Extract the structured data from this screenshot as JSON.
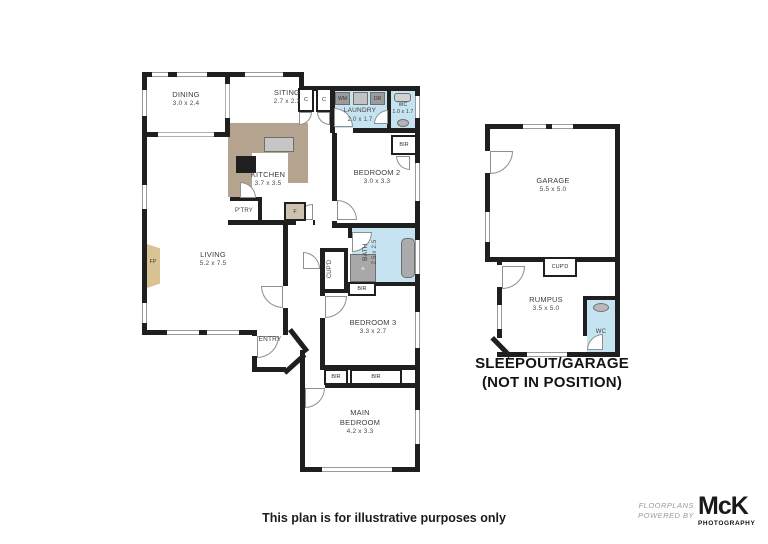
{
  "plan": {
    "rooms": {
      "dining": {
        "name": "DINING",
        "dims": "3.0 x 2.4"
      },
      "siting": {
        "name": "SITING",
        "dims": "2.7 x 2.3"
      },
      "kitchen": {
        "name": "KITCHEN",
        "dims": "3.7 x 3.5"
      },
      "laundry": {
        "name": "LAUNDRY",
        "dims": "2.0 x 1.7"
      },
      "wc": {
        "name": "WC",
        "dims": "1.0 x 1.7"
      },
      "bedroom2": {
        "name": "BEDROOM 2",
        "dims": "3.0 x 3.3"
      },
      "living": {
        "name": "LIVING",
        "dims": "5.2 x 7.5"
      },
      "bath": {
        "name": "BATH",
        "dims": "2.5 x 2.5"
      },
      "bedroom3": {
        "name": "BEDROOM 3",
        "dims": "3.3 x 2.7"
      },
      "main_bedroom": {
        "name": "MAIN BEDROOM",
        "dims": "4.2 x 3.3"
      },
      "entry": {
        "name": "ENTRY"
      },
      "pantry": {
        "name": "P'TRY"
      },
      "garage": {
        "name": "GARAGE",
        "dims": "5.5 x 5.0"
      },
      "rumpus": {
        "name": "RUMPUS",
        "dims": "3.5 x 5.0"
      },
      "wc_sleepout": {
        "name": "WC"
      }
    },
    "fixtures": {
      "closet": "C",
      "washing_machine": "WM",
      "dryer": "DR",
      "fridge": "F",
      "fireplace": "FP",
      "built_in_robe": "BIR",
      "cupboard": "CUP'D"
    },
    "sleepout_note": {
      "line1": "SLEEPOUT/GARAGE",
      "line2": "(NOT IN POSITION)"
    }
  },
  "footer": {
    "disclaimer": "This plan is for illustrative purposes only"
  },
  "logo": {
    "tagline_line1": "FLOORPLANS",
    "tagline_line2": "POWERED BY",
    "brand": "McK",
    "brand_sub": "PHOTOGRAPHY"
  },
  "colors": {
    "wall": "#1f1f1f",
    "wet_area": "#c6e3f1",
    "counter": "#b4a48f",
    "fireplace": "#d9c395",
    "appliance": "#9b9b9b"
  }
}
